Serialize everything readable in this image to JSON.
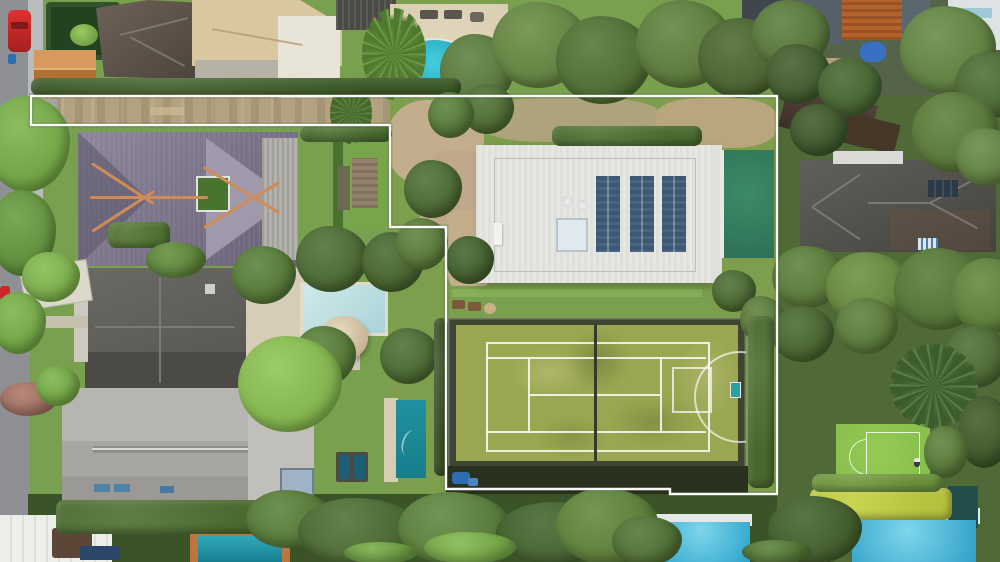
{
  "scene_type": "aerial-drone-photo-with-property-boundary-overlay",
  "inventory": [
    "street",
    "red-car",
    "terracotta-shed",
    "hedge-garden",
    "tan-roof-house",
    "courtyard-pool",
    "palm-trees",
    "driveway-corridor",
    "federation-purple-roof-house",
    "metal-roof-wing",
    "dark-gray-roof-house",
    "pale-pool",
    "spa-dome",
    "light-gray-roof-house",
    "carport",
    "lap-pool",
    "trampoline-spa",
    "white-flat-roof-house",
    "solar-panel-arrays",
    "skylight",
    "emerald-pool",
    "grass-tennis-court",
    "basketball-hoop",
    "small-practice-court",
    "palm-canopy",
    "brick-apartment",
    "dark-hip-roof-house",
    "azure-pools",
    "yellow-hedge",
    "tree-canopy"
  ],
  "colors": {
    "road": "#8f9094",
    "path": "#b9bcbd",
    "lawn": "#79a04e",
    "lawnBright": "#8cb45c",
    "canopyDark": "#3a5427",
    "eastBase": "#4f6a36",
    "corridorDirt": "#b3a27f",
    "sand": "#c2ad8c",
    "boundary": "#ffffff",
    "purpleRoof": "#675f76",
    "purpleRoofLight": "#8d879b",
    "ridgeOrange": "#cf8b58",
    "metalRoof": "#b3b1ab",
    "grayRoofDark": "#5e5d58",
    "grayRoofDarker": "#47463f",
    "grayRoofLight": "#a7a6a2",
    "grayRoofPale": "#c0bfbb",
    "whiteRoof": "#e6e6e3",
    "solar": "#7d96ab",
    "emeraldPool": "#2e7055",
    "turquoisePool": "#28b6cc",
    "palePool": "#c6e3e4",
    "tealPool": "#177e8c",
    "azurePool": "#4fc0dd",
    "courtGrass": "#9aa750",
    "courtBorder": "#3f4533",
    "courtShadow": "#29301d",
    "smallCourt": "#84bb4a",
    "yellowHedge": "#b5c23f",
    "tanRoof": "#d9c7a0",
    "brickOrange": "#b4622c",
    "shedOrange": "#c6803f",
    "carRed": "#d42a2a",
    "cream": "#d9cdb2",
    "domeTan": "#d6c6a6",
    "brownRoof": "#4a3a2e"
  },
  "property_boundary": {
    "color": "#ffffff",
    "stroke_width": 2.4,
    "points": [
      [
        31,
        96
      ],
      [
        777,
        96
      ],
      [
        777,
        494
      ],
      [
        670,
        494
      ],
      [
        670,
        489
      ],
      [
        446,
        489
      ],
      [
        446,
        227
      ],
      [
        390,
        227
      ],
      [
        390,
        125
      ],
      [
        31,
        125
      ]
    ]
  },
  "vegetation": [
    {
      "x": 440,
      "y": 34,
      "w": 74,
      "h": 74,
      "c": "#56743a",
      "s": "t"
    },
    {
      "x": 492,
      "y": 2,
      "w": 96,
      "h": 86,
      "c": "#5f7e3e",
      "s": "t"
    },
    {
      "x": 556,
      "y": 16,
      "w": 96,
      "h": 88,
      "c": "#4c6930",
      "s": "t"
    },
    {
      "x": 636,
      "y": 0,
      "w": 96,
      "h": 88,
      "c": "#587638",
      "s": "t"
    },
    {
      "x": 698,
      "y": 18,
      "w": 88,
      "h": 80,
      "c": "#465f2d",
      "s": "t"
    },
    {
      "x": 752,
      "y": 0,
      "w": 78,
      "h": 70,
      "c": "#547137",
      "s": "t"
    },
    {
      "x": 766,
      "y": 44,
      "w": 64,
      "h": 60,
      "c": "#3d572b",
      "s": "t"
    },
    {
      "x": 818,
      "y": 58,
      "w": 64,
      "h": 58,
      "c": "#42602e",
      "s": "t"
    },
    {
      "x": 900,
      "y": 6,
      "w": 96,
      "h": 88,
      "c": "#5d7c3e",
      "s": "t"
    },
    {
      "x": 955,
      "y": 52,
      "w": 72,
      "h": 66,
      "c": "#486430",
      "s": "t"
    },
    {
      "x": 912,
      "y": 92,
      "w": 86,
      "h": 80,
      "c": "#557335",
      "s": "t"
    },
    {
      "x": 790,
      "y": 104,
      "w": 58,
      "h": 52,
      "c": "#3a5329",
      "s": "t"
    },
    {
      "x": 956,
      "y": 128,
      "w": 62,
      "h": 58,
      "c": "#5d7c3e",
      "s": "t"
    },
    {
      "x": 362,
      "y": 8,
      "w": 64,
      "h": 92,
      "c": "#4f7a2e",
      "s": "p"
    },
    {
      "x": 330,
      "y": 82,
      "w": 42,
      "h": 62,
      "c": "#44682a",
      "s": "p"
    },
    {
      "x": 31,
      "y": 78,
      "w": 430,
      "h": 18,
      "c": "#3e5a2a",
      "s": "h"
    },
    {
      "x": 300,
      "y": 126,
      "w": 92,
      "h": 16,
      "c": "#4a6a2f",
      "s": "h"
    },
    {
      "x": 552,
      "y": 126,
      "w": 150,
      "h": 20,
      "c": "#4a6a2f",
      "s": "h"
    },
    {
      "x": -14,
      "y": 96,
      "w": 84,
      "h": 96,
      "c": "#6fa143",
      "s": "t"
    },
    {
      "x": -10,
      "y": 190,
      "w": 66,
      "h": 86,
      "c": "#5d8c3a",
      "s": "t"
    },
    {
      "x": 22,
      "y": 252,
      "w": 58,
      "h": 50,
      "c": "#77a848",
      "s": "t"
    },
    {
      "x": -8,
      "y": 292,
      "w": 54,
      "h": 62,
      "c": "#6fa143",
      "s": "t"
    },
    {
      "x": 108,
      "y": 222,
      "w": 62,
      "h": 26,
      "c": "#4f7030",
      "s": "h"
    },
    {
      "x": 146,
      "y": 242,
      "w": 60,
      "h": 36,
      "c": "#5a8038",
      "s": "t"
    },
    {
      "x": 232,
      "y": 246,
      "w": 64,
      "h": 58,
      "c": "#527434",
      "s": "t"
    },
    {
      "x": 296,
      "y": 226,
      "w": 72,
      "h": 66,
      "c": "#486530",
      "s": "t"
    },
    {
      "x": 362,
      "y": 232,
      "w": 62,
      "h": 60,
      "c": "#44602c",
      "s": "t"
    },
    {
      "x": 294,
      "y": 326,
      "w": 62,
      "h": 60,
      "c": "#527434",
      "s": "t"
    },
    {
      "x": 238,
      "y": 336,
      "w": 104,
      "h": 96,
      "c": "#7fb04b",
      "s": "t"
    },
    {
      "x": 380,
      "y": 328,
      "w": 58,
      "h": 56,
      "c": "#486530",
      "s": "t"
    },
    {
      "x": 0,
      "y": 382,
      "w": 58,
      "h": 34,
      "c": "#9c6b5e",
      "s": "t"
    },
    {
      "x": 36,
      "y": 366,
      "w": 44,
      "h": 40,
      "c": "#6fa143",
      "s": "t"
    },
    {
      "x": 404,
      "y": 160,
      "w": 58,
      "h": 58,
      "c": "#486530",
      "s": "t"
    },
    {
      "x": 396,
      "y": 218,
      "w": 52,
      "h": 52,
      "c": "#567436",
      "s": "t"
    },
    {
      "x": 446,
      "y": 236,
      "w": 48,
      "h": 48,
      "c": "#3f5c2a",
      "s": "t"
    },
    {
      "x": 462,
      "y": 84,
      "w": 52,
      "h": 50,
      "c": "#4a6730",
      "s": "t"
    },
    {
      "x": 428,
      "y": 92,
      "w": 46,
      "h": 46,
      "c": "#527434",
      "s": "t"
    },
    {
      "x": 712,
      "y": 270,
      "w": 44,
      "h": 42,
      "c": "#486530",
      "s": "t"
    },
    {
      "x": 740,
      "y": 296,
      "w": 44,
      "h": 46,
      "c": "#567436",
      "s": "t"
    },
    {
      "x": 772,
      "y": 246,
      "w": 72,
      "h": 62,
      "c": "#567436",
      "s": "t"
    },
    {
      "x": 826,
      "y": 252,
      "w": 84,
      "h": 72,
      "c": "#62823c",
      "s": "t"
    },
    {
      "x": 894,
      "y": 248,
      "w": 92,
      "h": 82,
      "c": "#507033",
      "s": "t"
    },
    {
      "x": 952,
      "y": 258,
      "w": 74,
      "h": 76,
      "c": "#5a7a38",
      "s": "t"
    },
    {
      "x": 772,
      "y": 306,
      "w": 62,
      "h": 56,
      "c": "#44602c",
      "s": "t"
    },
    {
      "x": 836,
      "y": 298,
      "w": 62,
      "h": 56,
      "c": "#567436",
      "s": "t"
    },
    {
      "x": 944,
      "y": 326,
      "w": 64,
      "h": 62,
      "c": "#486430",
      "s": "t"
    },
    {
      "x": 890,
      "y": 344,
      "w": 88,
      "h": 84,
      "c": "#3c5c2a",
      "s": "p"
    },
    {
      "x": 958,
      "y": 396,
      "w": 54,
      "h": 72,
      "c": "#3c5628",
      "s": "t"
    },
    {
      "x": 924,
      "y": 426,
      "w": 44,
      "h": 52,
      "c": "#567436",
      "s": "t"
    },
    {
      "x": 748,
      "y": 316,
      "w": 26,
      "h": 172,
      "c": "#48662e",
      "s": "h"
    },
    {
      "x": 434,
      "y": 318,
      "w": 14,
      "h": 158,
      "c": "#384e24",
      "s": "h"
    },
    {
      "x": 810,
      "y": 488,
      "w": 142,
      "h": 32,
      "c": "#b5c23f",
      "s": "h"
    },
    {
      "x": 812,
      "y": 474,
      "w": 130,
      "h": 18,
      "c": "#6a8f3a",
      "s": "h"
    },
    {
      "x": 56,
      "y": 500,
      "w": 228,
      "h": 34,
      "c": "#4a6a2f",
      "s": "h"
    },
    {
      "x": 246,
      "y": 490,
      "w": 86,
      "h": 58,
      "c": "#527434",
      "s": "t"
    },
    {
      "x": 298,
      "y": 498,
      "w": 122,
      "h": 66,
      "c": "#486530",
      "s": "t"
    },
    {
      "x": 398,
      "y": 492,
      "w": 112,
      "h": 72,
      "c": "#567838",
      "s": "t"
    },
    {
      "x": 496,
      "y": 502,
      "w": 122,
      "h": 62,
      "c": "#3f5c2a",
      "s": "t"
    },
    {
      "x": 556,
      "y": 488,
      "w": 102,
      "h": 76,
      "c": "#5a7a38",
      "s": "t"
    },
    {
      "x": 424,
      "y": 532,
      "w": 92,
      "h": 32,
      "c": "#73a344",
      "s": "t"
    },
    {
      "x": 344,
      "y": 542,
      "w": 74,
      "h": 22,
      "c": "#6b9a40",
      "s": "t"
    },
    {
      "x": 612,
      "y": 516,
      "w": 70,
      "h": 50,
      "c": "#4c6a31",
      "s": "t"
    },
    {
      "x": 768,
      "y": 496,
      "w": 94,
      "h": 68,
      "c": "#3f5a2a",
      "s": "t"
    },
    {
      "x": 742,
      "y": 540,
      "w": 70,
      "h": 24,
      "c": "#527434",
      "s": "t"
    }
  ]
}
